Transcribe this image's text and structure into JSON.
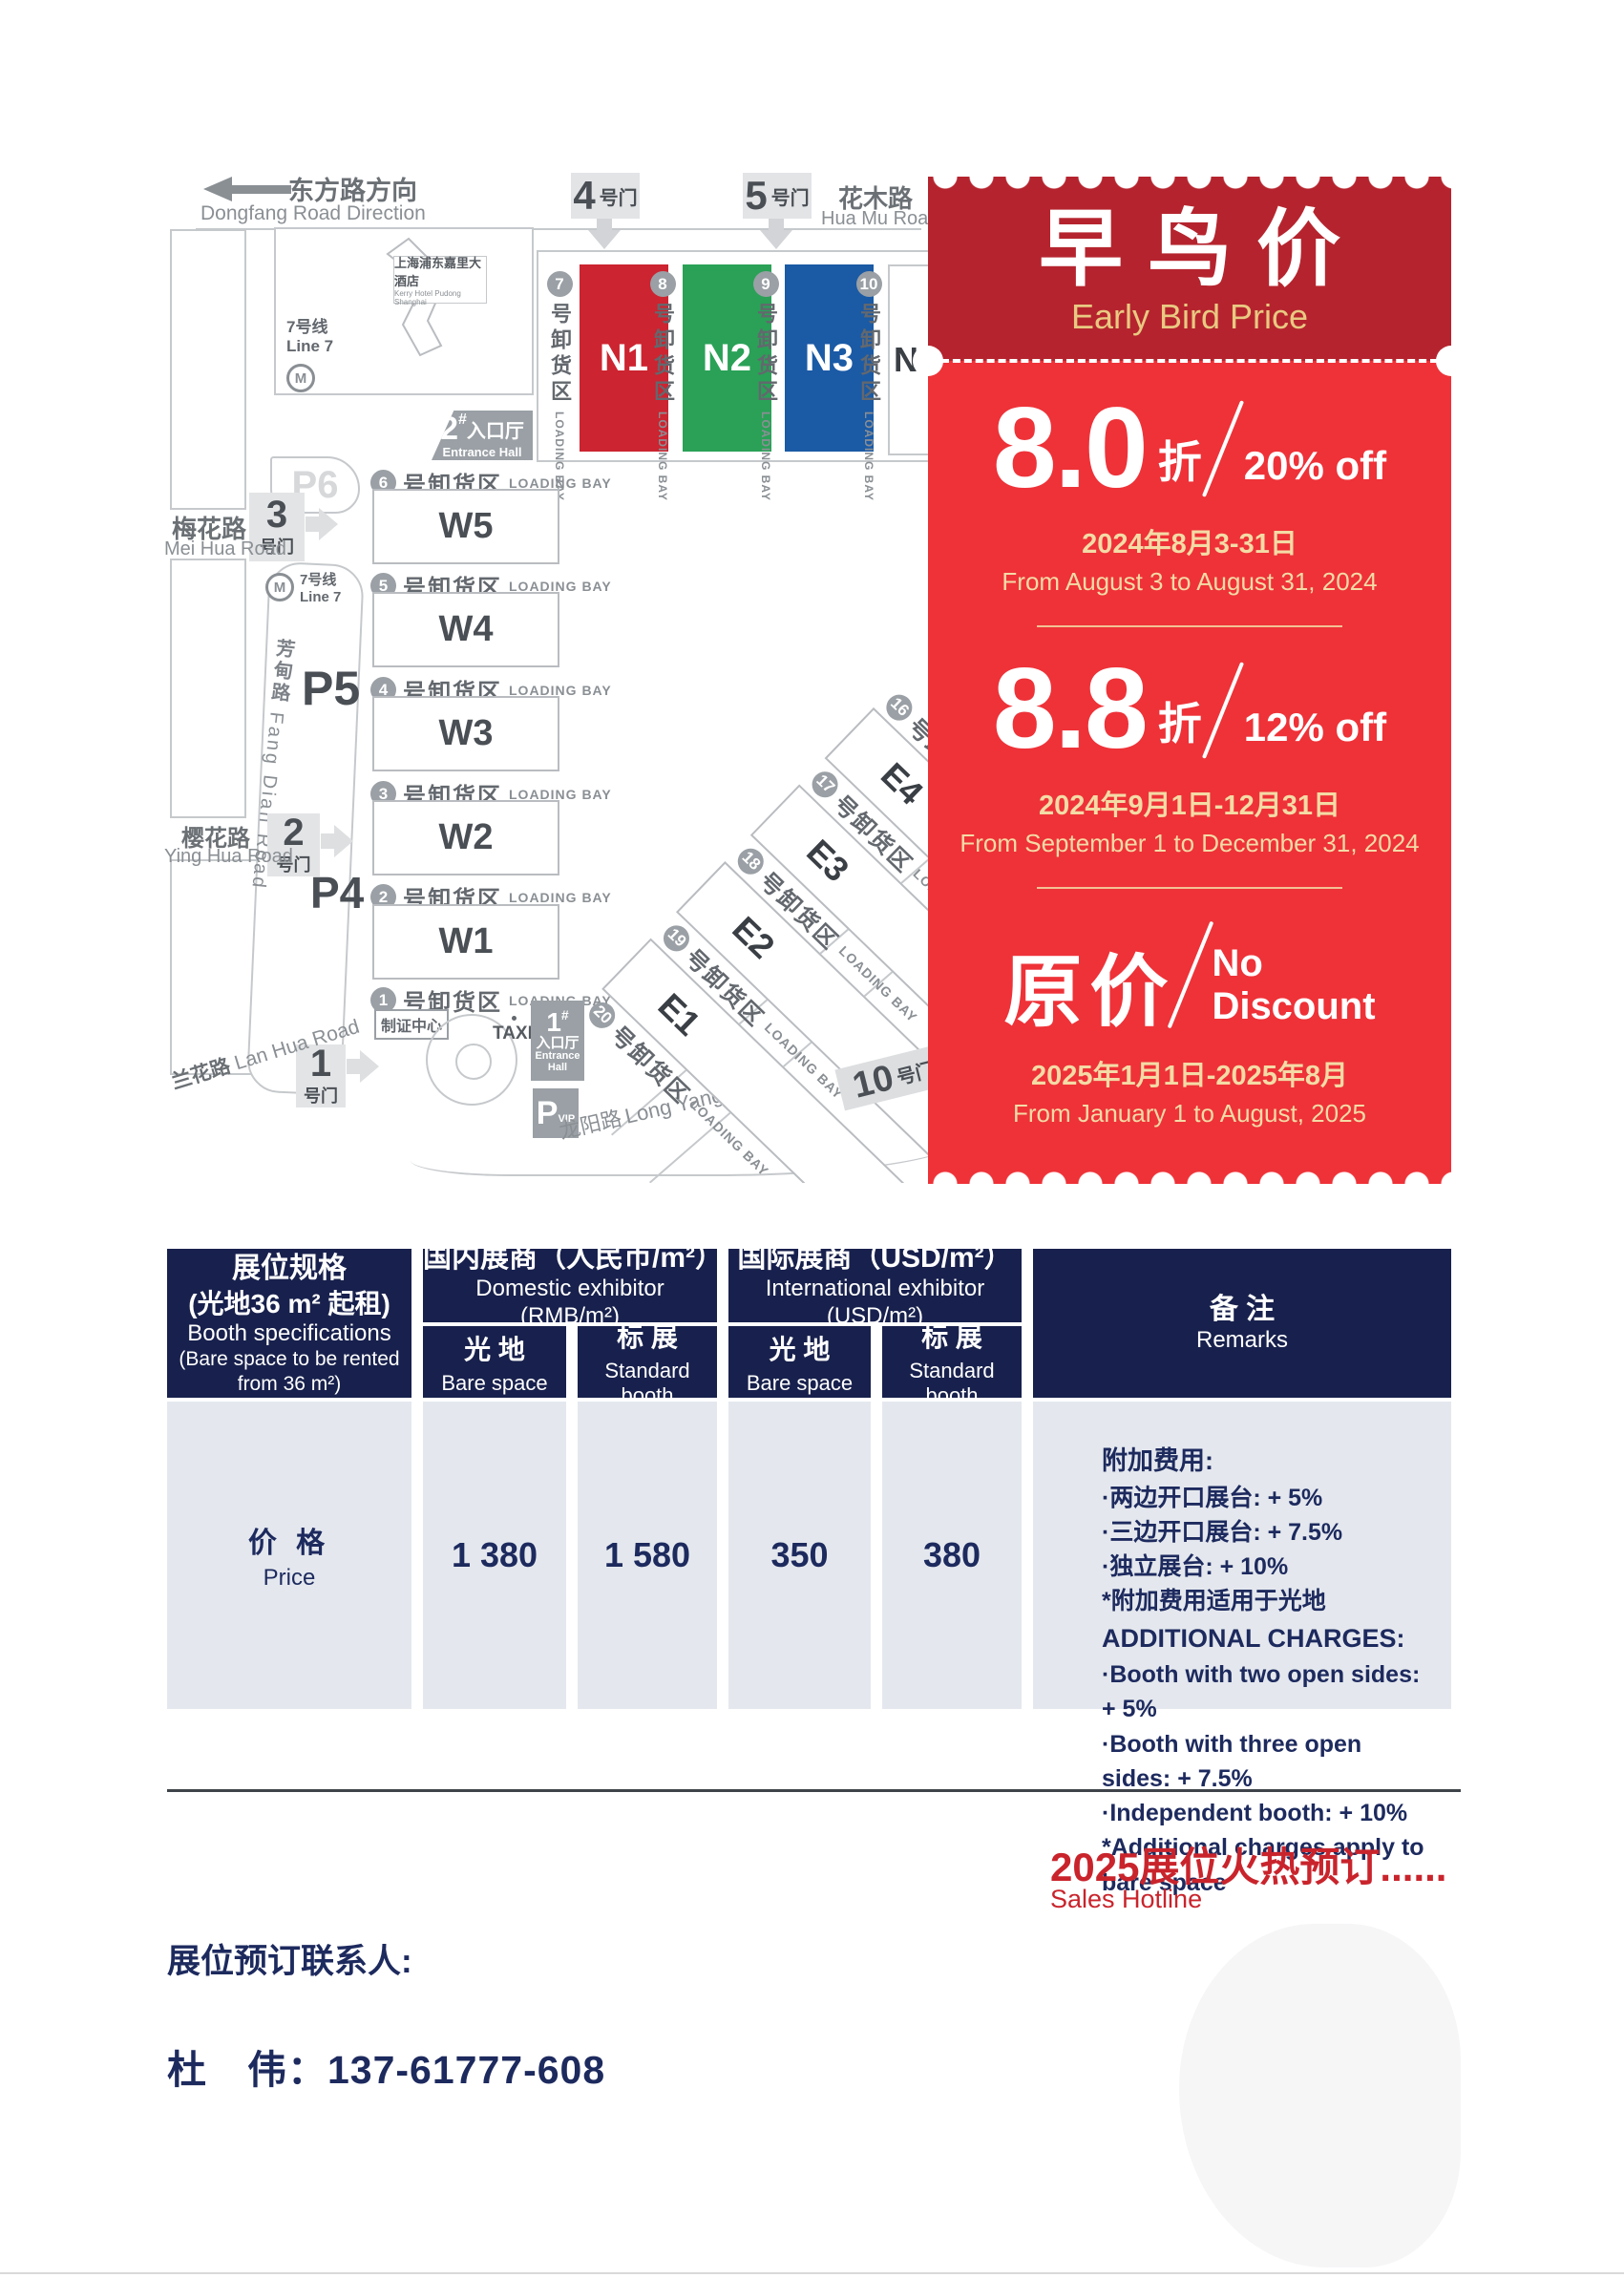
{
  "map": {
    "direction": {
      "cn": "东方路方向",
      "en": "Dongfang Road Direction"
    },
    "gate_suffix": "号门",
    "gates": {
      "g1": "1",
      "g2": "2",
      "g3": "3",
      "g4": "4",
      "g5": "5",
      "g10": "10"
    },
    "roads": {
      "huamu_cn": "花木路",
      "huamu_en": "Hua Mu Road",
      "meihua_cn": "梅花路",
      "meihua_en": "Mei Hua Road",
      "yinghua_cn": "樱花路",
      "yinghua_en": "Ying Hua Road",
      "lanhua_cn": "兰花路",
      "lanhua_en": "Lan Hua Road",
      "fangdian_cn": "芳甸路",
      "fangdian_en": "Fang Dian Road",
      "longyang_cn": "龙阳路",
      "longyang_en": "Long Yang Road"
    },
    "hotel": {
      "cn": "上海浦东嘉里大酒店",
      "en": "Kerry Hotel Pudong Shanghai"
    },
    "metro": {
      "cn": "7号线",
      "en": "Line 7",
      "icon": "M"
    },
    "parking": {
      "p4": "P4",
      "p5": "P5",
      "p6": "P6",
      "vip_p": "P",
      "vip_sub": "VIP"
    },
    "entrance": {
      "e1_num": "1",
      "e2_num": "2",
      "hash": "#",
      "cn": "入口厅",
      "en": "Entrance Hall",
      "en1": "Entrance",
      "en2": "Hall"
    },
    "badge_center": "制证中心",
    "taxi": "TAXI",
    "bay": {
      "cn": "号卸货区",
      "en": "LOADING BAY"
    },
    "bays": {
      "b1": "1",
      "b2": "2",
      "b3": "3",
      "b4": "4",
      "b5": "5",
      "b6": "6",
      "b7": "7",
      "b8": "8",
      "b9": "9",
      "b10": "10",
      "b16": "16",
      "b17": "17",
      "b18": "18",
      "b19": "19",
      "b20": "20"
    },
    "halls": {
      "n1": "N1",
      "n2": "N2",
      "n3": "N3",
      "n4": "N4",
      "w1": "W1",
      "w2": "W2",
      "w3": "W3",
      "w4": "W4",
      "w5": "W5",
      "e1": "E1",
      "e2": "E2",
      "e3": "E3",
      "e4": "E4"
    },
    "hall_colors": {
      "n1": "#cc2430",
      "n2": "#2aa157",
      "n3": "#1b5aa5"
    }
  },
  "ticket": {
    "title_cn": "早鸟价",
    "title_en": "Early Bird Price",
    "tier1": {
      "value": "8.0",
      "unit": "折",
      "off": "20% off",
      "date_cn": "2024年8月3-31日",
      "date_en": "From August 3 to August 31, 2024"
    },
    "tier2": {
      "value": "8.8",
      "unit": "折",
      "off": "12% off",
      "date_cn": "2024年9月1日-12月31日",
      "date_en": "From September 1 to December 31, 2024"
    },
    "tier3": {
      "value": "原价",
      "off1": "No",
      "off2": "Discount",
      "date_cn": "2025年1月1日-2025年8月",
      "date_en": "From January 1 to August, 2025"
    },
    "colors": {
      "header_red": "#b5242e",
      "body_red": "#ee3238",
      "gold": "#e9c982",
      "navy": "#18214d"
    }
  },
  "table": {
    "spec": {
      "cn1": "展位规格",
      "cn2": "(光地36 m² 起租)",
      "en1": "Booth specifications",
      "en2": "(Bare space to be rented",
      "en3": "from 36 m²)"
    },
    "domestic": {
      "cn": "国内展商（人民币/m²）",
      "en": "Domestic exhibitor (RMB/m²)"
    },
    "intl": {
      "cn": "国际展商（USD/m²）",
      "en": "International exhibitor (USD/m²)"
    },
    "remarks_header": {
      "cn": "备 注",
      "en": "Remarks"
    },
    "sub_bare": {
      "cn": "光 地",
      "en": "Bare space"
    },
    "sub_std": {
      "cn": "标 展",
      "en": "Standard booth"
    },
    "price_row": {
      "cn": "价 格",
      "en": "Price",
      "v1": "1 380",
      "v2": "1 580",
      "v3": "350",
      "v4": "380"
    },
    "remarks": {
      "cn_title": "附加费用:",
      "cn_items": [
        "·两边开口展台: + 5%",
        "·三边开口展台: + 7.5%",
        "·独立展台: + 10%",
        "*附加费用适用于光地"
      ],
      "en_title": "ADDITIONAL CHARGES:",
      "en_items": [
        "·Booth with two open sides: + 5%",
        "·Booth with three open sides: + 7.5%",
        "·Independent booth: + 10%",
        "*Additional charges apply to bare space"
      ]
    }
  },
  "footer": {
    "hot_cn": "2025展位火热预订......",
    "hot_en": "Sales Hotline",
    "contact_label": "展位预订联系人:",
    "contact_value": "杜　伟：137-61777-608"
  }
}
